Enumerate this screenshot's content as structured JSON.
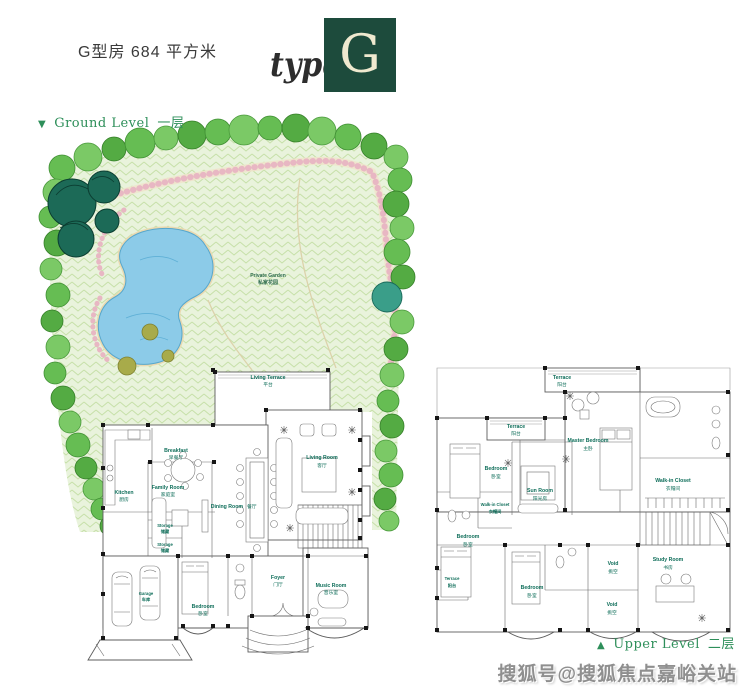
{
  "header": {
    "title": "G型房 684 平方米"
  },
  "type_badge": {
    "word": "type",
    "letter": "G"
  },
  "levels": {
    "ground": {
      "marker": "▼",
      "en": "Ground Level",
      "cn": "一层"
    },
    "upper": {
      "marker": "▲",
      "en": "Upper Level",
      "cn": "二层"
    }
  },
  "ground_rooms": {
    "private_garden": {
      "en": "Private Garden",
      "cn": "私家花园"
    },
    "living_terrace": {
      "en": "Living Terrace",
      "cn": "平台"
    },
    "living_room": {
      "en": "Living Room",
      "cn": "客厅"
    },
    "breakfast": {
      "en": "Breakfast",
      "cn": "早餐厅"
    },
    "family_room": {
      "en": "Family Room",
      "cn": "家庭室"
    },
    "kitchen": {
      "en": "Kitchen",
      "cn": "厨房"
    },
    "dining_room": {
      "en": "Dining Room",
      "cn": "餐厅"
    },
    "storage_1": {
      "en": "Storage",
      "cn": "储藏"
    },
    "storage_2": {
      "en": "Storage",
      "cn": "储藏"
    },
    "garage": {
      "en": "Garage",
      "cn": "车库"
    },
    "bedroom": {
      "en": "Bedroom",
      "cn": "卧室"
    },
    "foyer": {
      "en": "Foyer",
      "cn": "门厅"
    },
    "music_room": {
      "en": "Music Room",
      "cn": "音乐室"
    }
  },
  "upper_rooms": {
    "terrace_top": {
      "en": "Terrace",
      "cn": "阳台"
    },
    "master_bedroom": {
      "en": "Master Bedroom",
      "cn": "主卧"
    },
    "master_closet": {
      "en": "Walk-in Closet",
      "cn": "衣帽间"
    },
    "terrace_left": {
      "en": "Terrace",
      "cn": "阳台"
    },
    "bedroom_left": {
      "en": "Bedroom",
      "cn": "卧室"
    },
    "sun_room": {
      "en": "Sun Room",
      "cn": "阳光房"
    },
    "walkin_closet": {
      "en": "Walk-in Closet",
      "cn": "衣帽间"
    },
    "bedroom_lower_left": {
      "en": "Bedroom",
      "cn": "卧室"
    },
    "terrace_small": {
      "en": "Terrace",
      "cn": "阳台"
    },
    "bedroom_lower": {
      "en": "Bedroom",
      "cn": "卧室"
    },
    "void_1": {
      "en": "Void",
      "cn": "挑空"
    },
    "void_2": {
      "en": "Void",
      "cn": "挑空"
    },
    "study_room": {
      "en": "Study Room",
      "cn": "书房"
    }
  },
  "watermark": {
    "text": "搜狐号@搜狐焦点嘉峪关站"
  },
  "colors": {
    "logo_green": "#1d4b3c",
    "logo_letter": "#efe9cf",
    "level_label_green": "#2e8f5a",
    "room_label_teal": "#0f6e5a",
    "pond_blue": "#8ccbe8",
    "grass_light": "#e9f3dc",
    "tree_green": "#63bb51",
    "watermark_gray": "#8f8f8f"
  }
}
